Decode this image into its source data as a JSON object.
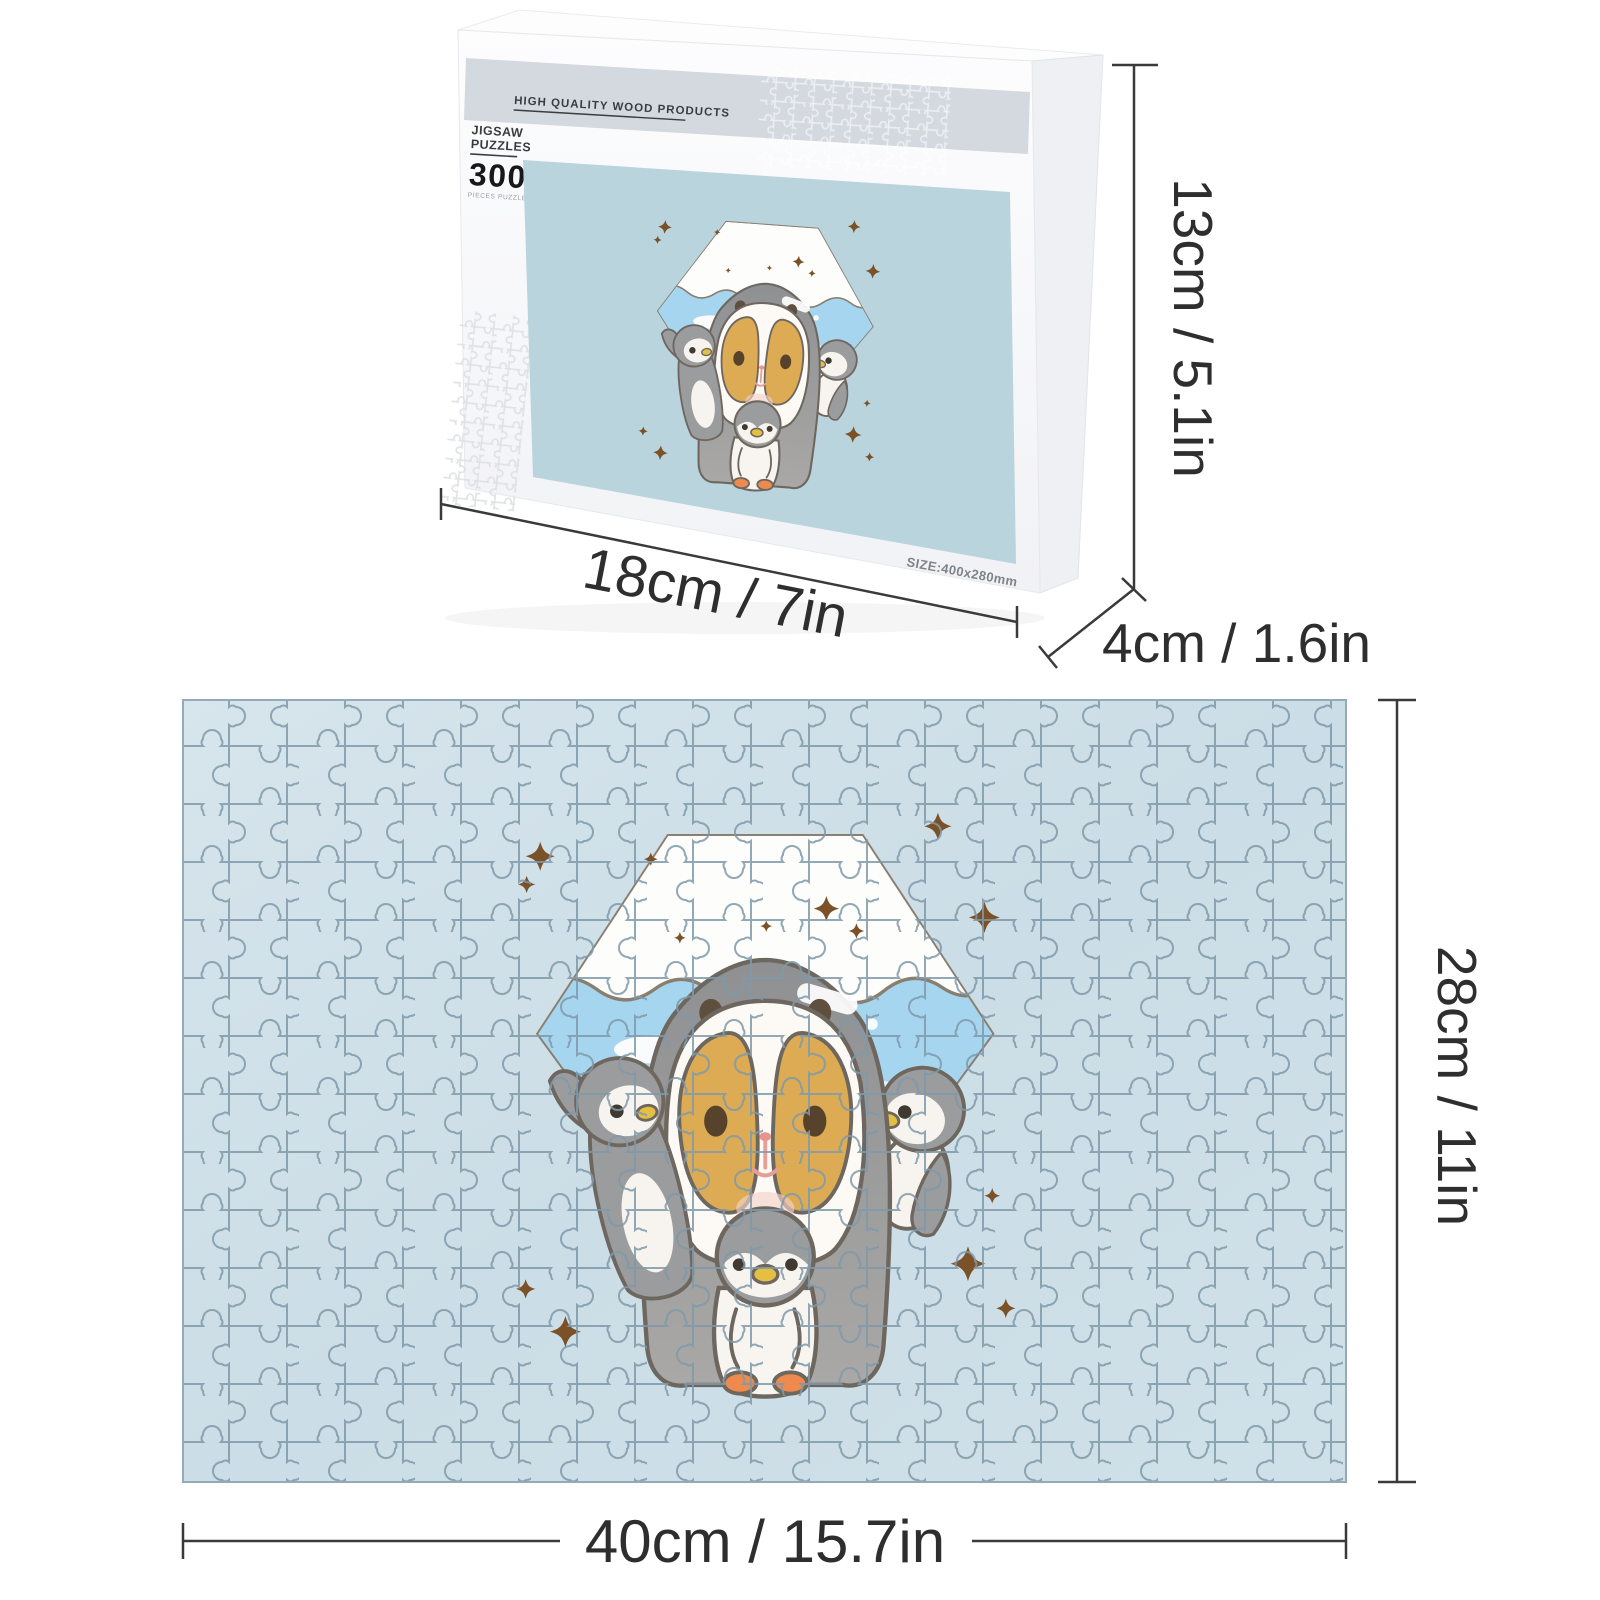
{
  "box": {
    "brand_line": "HIGH QUALITY WOOD PRODUCTS",
    "label_line1": "JIGSAW",
    "label_line2": "PUZZLES",
    "piece_count": "300",
    "piece_caption": "PIECES PUZZLE",
    "size_note": "SIZE:400x280mm"
  },
  "dimensions": {
    "box_height": "13cm / 5.1in",
    "box_width": "18cm / 7in",
    "box_depth": "4cm / 1.6in",
    "puzzle_height": "28cm / 11in",
    "puzzle_width": "40cm / 15.7in"
  },
  "artwork": {
    "name": "penguin-family-mount-fuji",
    "description": "Guinea pig in a penguin hood with three penguin chicks in front of a snow-capped Mount Fuji hexagon with sparkles"
  },
  "colors": {
    "puzzle_base": "#cddee7",
    "puzzle_lines": "#7f99a9",
    "art_background": "#b9d4dd",
    "box_band": "#d4d9df",
    "sparkle_brown": "#7b5127",
    "penguin_gray": "#9b9c9e",
    "outline_gray": "#6e675f",
    "patch_tan": "#dcab54",
    "beak_orange": "#e2552f",
    "chick_beak_yellow": "#e5bf41",
    "feet_orange": "#ee8a4e",
    "snow_blue": "#a6d6ef",
    "dimension_ink": "#2e2e2e"
  }
}
